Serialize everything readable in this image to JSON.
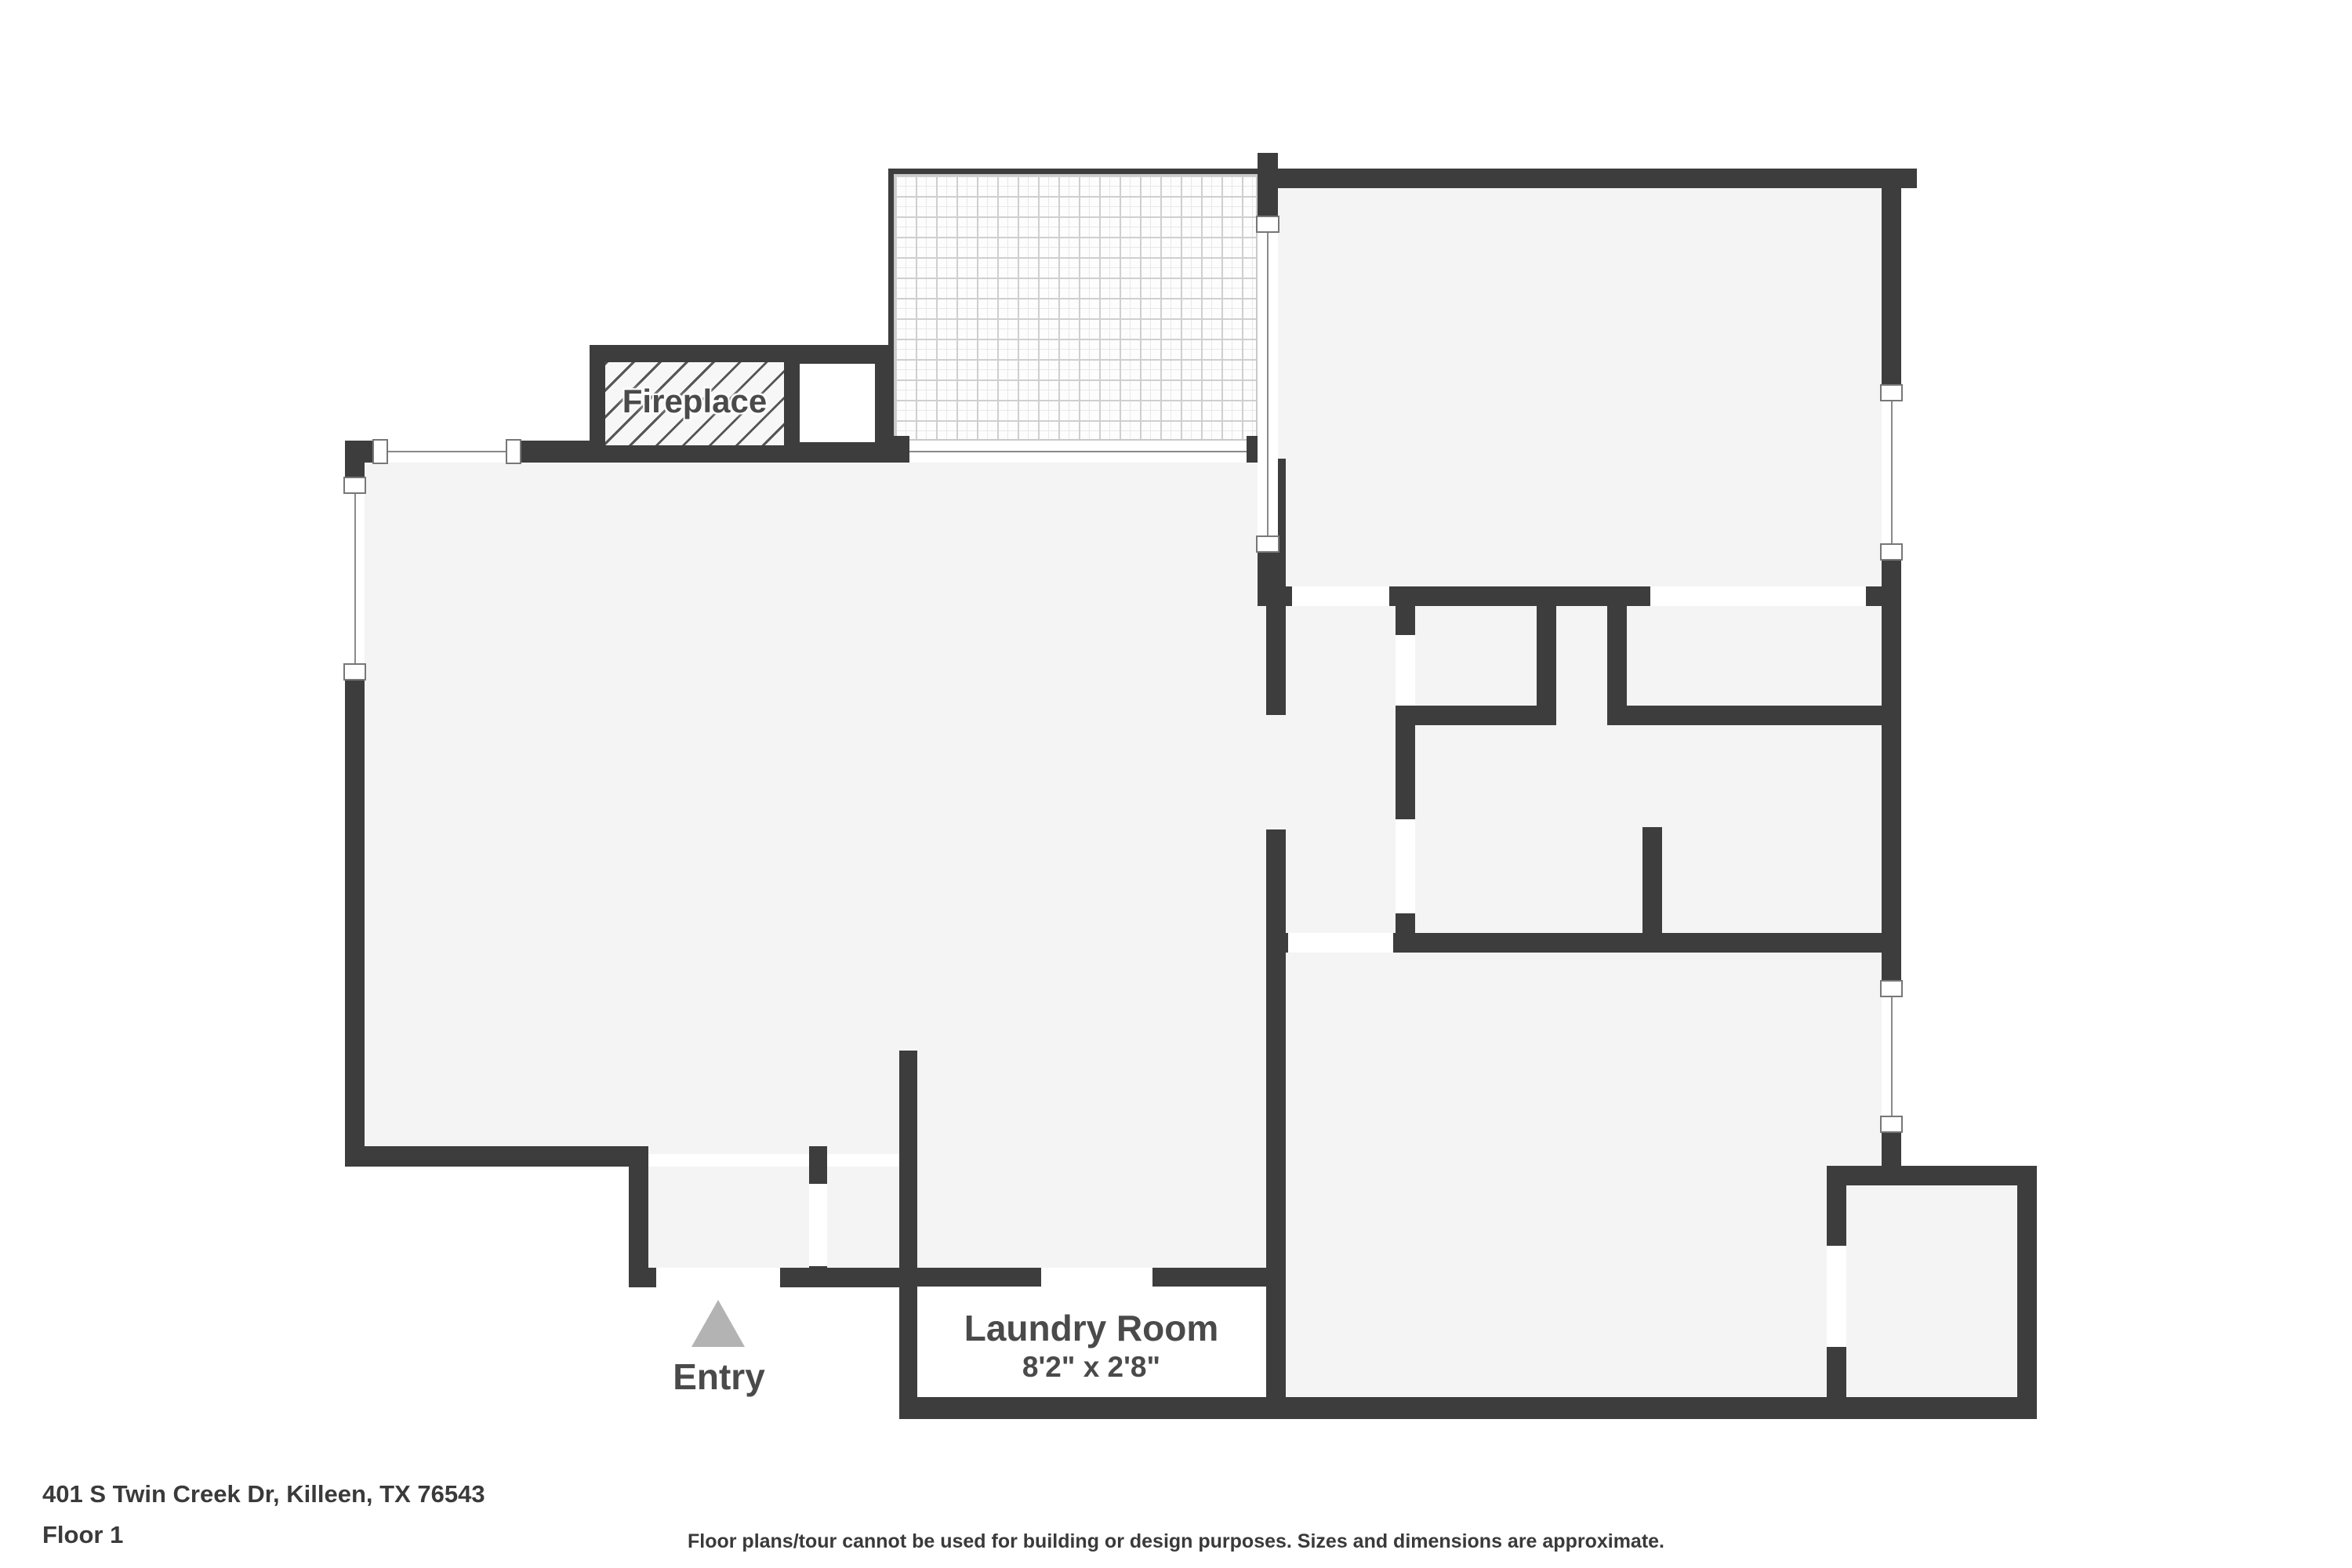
{
  "rooms": {
    "patio": {
      "name": "Patio",
      "dims": "8'9\" x 6'10\""
    },
    "bedroom1": {
      "name": "Bedroom",
      "dims": "14'3\" x 10'0\""
    },
    "dining": {
      "name": "Dining Room",
      "dims": "8'2\" x 8'10\""
    },
    "living": {
      "name": "Living Room",
      "dims": "12'11\" x 16'4\""
    },
    "closet_hall": {
      "name": "Closet"
    },
    "closet_bed1": {
      "name": "Closet",
      "dims": "5'11\" x 2'5\""
    },
    "bathroom": {
      "name": "Bathroom",
      "dims": "10'10\" x 5'1\""
    },
    "kitchen": {
      "name": "Kitchen",
      "dims": "8'2\" x 10'5\""
    },
    "bedroom2": {
      "name": "Bedroom",
      "dims": "14'3\" x 10'7\""
    },
    "closet_bed2": {
      "name": "Closet",
      "dims": "4'3\" x 5'2\""
    },
    "foyer": {
      "name": "Foyer",
      "dims": "3'11\" x 2'10\""
    },
    "laundry": {
      "name": "Laundry Room",
      "dims": "8'2\" x 2'8\""
    },
    "fireplace": {
      "name": "Fireplace"
    },
    "entry": {
      "name": "Entry"
    }
  },
  "footer": {
    "address": "401 S Twin Creek Dr, Killeen, TX 76543",
    "floor": "Floor 1",
    "disclaimer": "Floor plans/tour cannot be used for building or design purposes. Sizes and dimensions are approximate."
  },
  "colors": {
    "wall": "#3d3d3d",
    "floor": "#f4f4f4",
    "label_text": "#4a4a4a",
    "entry_arrow": "#b3b3b3"
  }
}
